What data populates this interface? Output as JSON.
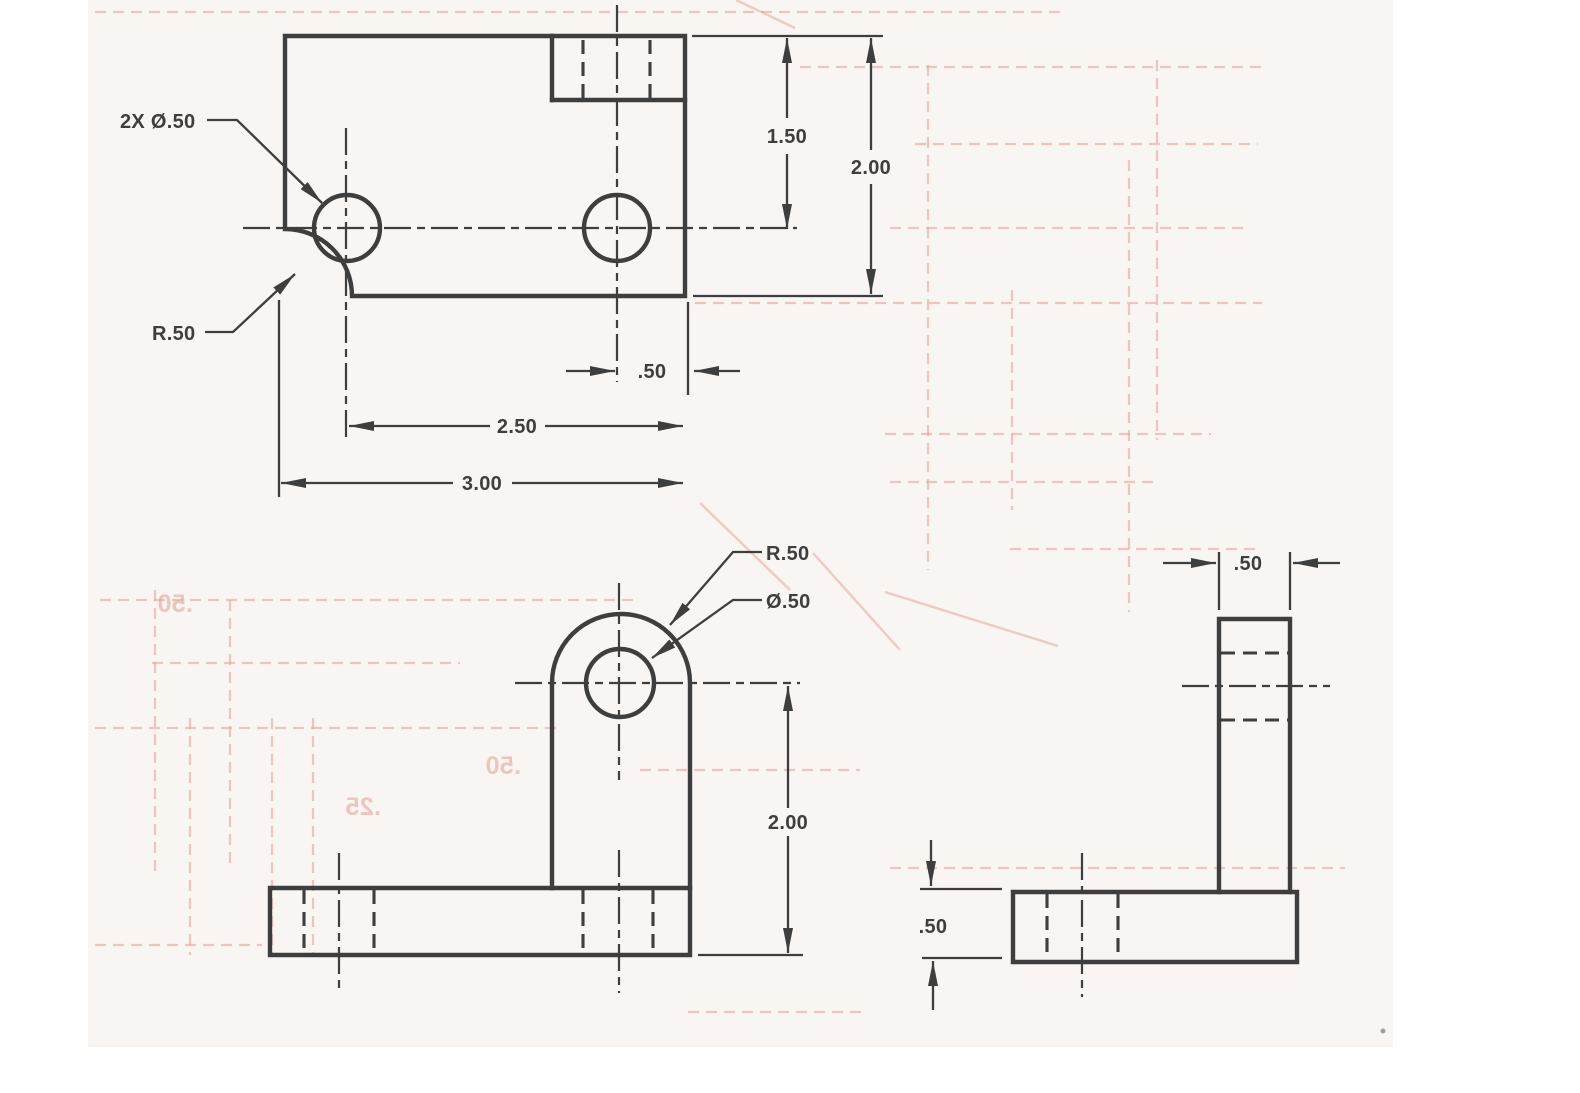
{
  "document": {
    "kind": "scanned three-view engineering drawing of an L-bracket",
    "units_style": "decimal inches"
  },
  "colors": {
    "paper": "#ffffff",
    "page": "#f8f5f2",
    "ink": "#333333",
    "ghost": "#dfa193",
    "speck": "#8a8a8a"
  },
  "views": {
    "top": {
      "callouts": {
        "holes": "2X Ø.50",
        "fillet": "R.50"
      },
      "dims": {
        "hole_to_top": "1.50",
        "depth": "2.00",
        "hole_to_edge": ".50",
        "hole_span": "2.50",
        "width": "3.00"
      }
    },
    "front": {
      "callouts": {
        "radius": "R.50",
        "hole": "Ø.50"
      },
      "dims": {
        "height": "2.00"
      }
    },
    "side": {
      "dims": {
        "arm_depth": ".50",
        "base_thickness": ".50"
      }
    }
  },
  "ghost": {
    "texts": [
      ".50",
      ".25",
      ".50"
    ]
  }
}
